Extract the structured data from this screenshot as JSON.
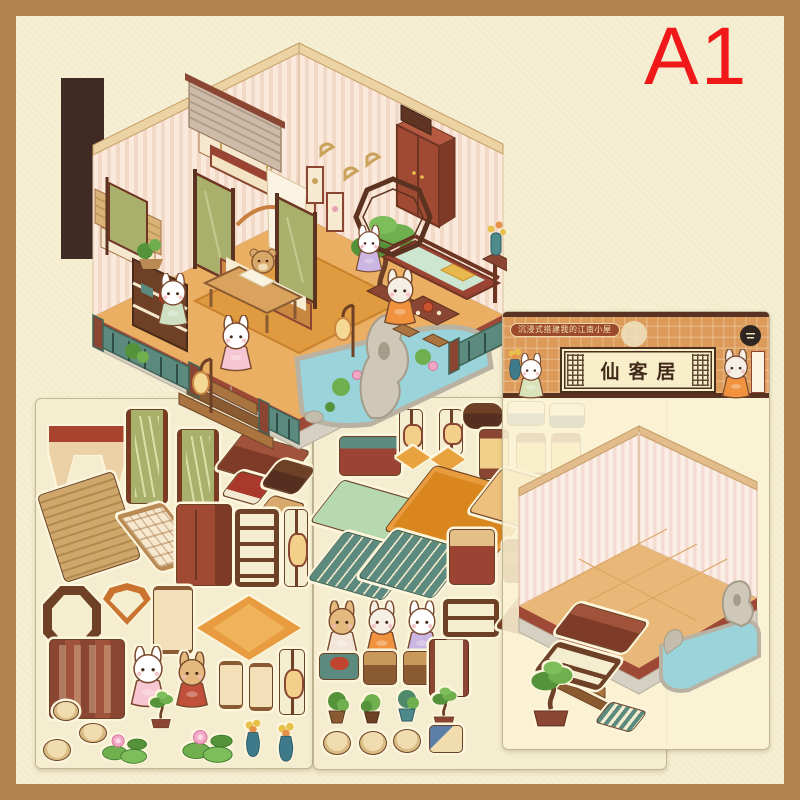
{
  "page": {
    "corner_label": "A1"
  },
  "packaging": {
    "tagline": "沉浸式搭建我的江南小屋",
    "title": "仙客居"
  },
  "colors": {
    "frame_brown": "#b2824e",
    "canvas_cream": "#f6efd3",
    "corner_label_red": "#f01818",
    "label_orange": "#dd9b5b",
    "label_dark_border": "#5a3222",
    "plaque_cream": "#f8eec9",
    "wood_red": "#9c4433",
    "railing_teal": "#5c8a7e",
    "banner_green": "#a9b06c",
    "floor_orange": "#eaaf63",
    "pond_blue": "#9ad4da",
    "stone_grey": "#d6d0c2",
    "dark_strip": "#3f2a24"
  },
  "inventory": {
    "main_illustration": [
      "striped-walls",
      "window-blind",
      "bamboo-blind",
      "canopy-bed",
      "green-bamboo-banners",
      "wardrobe",
      "display-shelf",
      "desk",
      "bonsai-tree",
      "daybed",
      "tea-table",
      "octagon-window",
      "swallow-paintings",
      "wall-scrolls",
      "floor-lanterns",
      "teal-railing",
      "stone-base",
      "steps",
      "lotus-pond",
      "garden-rock",
      "rabbit-figures",
      "cat-figure",
      "sleeping-bear"
    ],
    "sheet_left": [
      "curtain",
      "hanging-banner",
      "bench",
      "red-book",
      "suitcase",
      "storage-box",
      "bamboo-blind",
      "lattice-window",
      "wardrobe",
      "display-shelf",
      "lantern-stand",
      "octagon-window",
      "fan-window",
      "wall-scroll",
      "diamond-rug",
      "folding-screen",
      "rabbit-figure",
      "bear-figure",
      "mini-scroll",
      "floor-lantern",
      "rocks",
      "lotus-pads",
      "bonsai-pot",
      "flower-vases"
    ],
    "sheet_middle": [
      "teal-bench",
      "lantern-stands",
      "wooden-tray",
      "book-stacks",
      "cushions",
      "palace-lanterns",
      "green-mat",
      "large-rug",
      "runner-rug",
      "railings",
      "side-table",
      "chairs",
      "bear-figure",
      "cat-figure",
      "rabbit-figure",
      "food-plate",
      "box-stools",
      "cage-lantern",
      "low-shelf",
      "potted-plants",
      "buns-and-rocks"
    ],
    "sheet_right": [
      "room-backdrop",
      "striped-walls",
      "wood-floor",
      "red-floor-edge",
      "stone-skirt",
      "pond",
      "garden-rocks",
      "steps",
      "bench",
      "shelf",
      "bonsai",
      "mat-roll"
    ]
  }
}
